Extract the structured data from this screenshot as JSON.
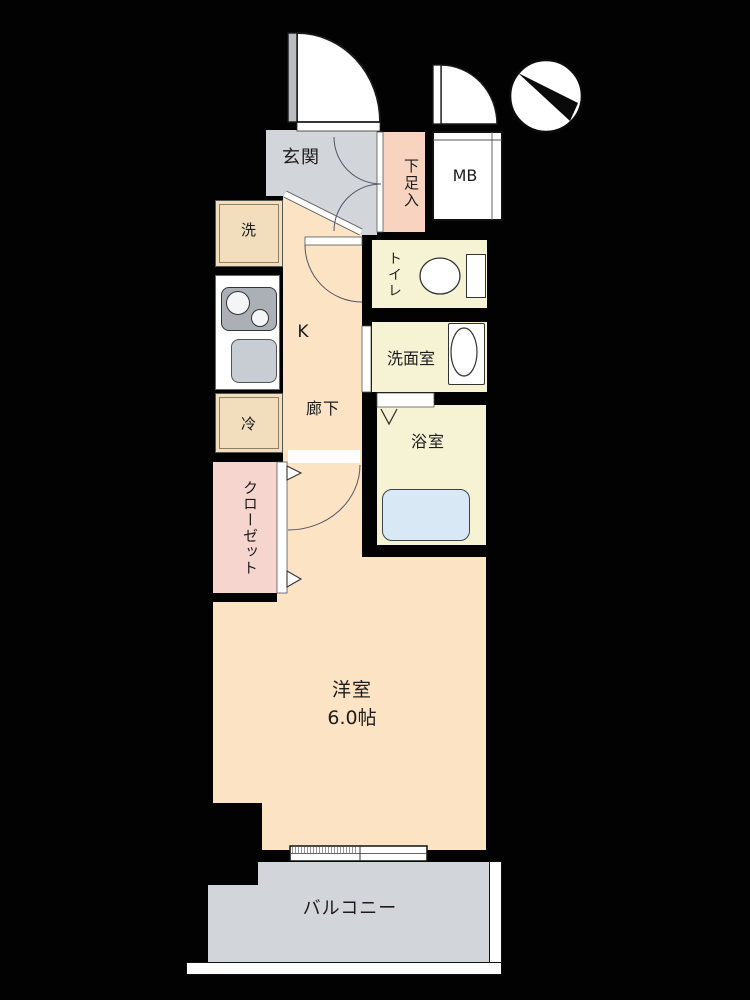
{
  "plan": {
    "type": "apartment-floor-plan",
    "rooms": {
      "genkan_label": "玄関",
      "shoe_cabinet_label": "下足入",
      "meter_box_label": "MB",
      "washer_label": "洗",
      "kitchen_label": "K",
      "hallway_label": "廊下",
      "refrigerator_label": "冷",
      "toilet_label": "トイレ",
      "washroom_label": "洗面室",
      "bathroom_label": "浴室",
      "closet_label": "クローゼット",
      "western_room_label": "洋室",
      "western_room_size": "6.0帖",
      "balcony_label": "バルコニー"
    },
    "icons": {
      "compass": "north-compass-icon",
      "entrance_door": "hinged-door-arc",
      "bathroom_door": "folding-door-mark",
      "window": "sliding-window-symbol"
    },
    "colors": {
      "wall": "#020202",
      "floor_peach": "#fbe3c4",
      "entrance_gray": "#d2d5da",
      "wet_room_yellow": "#f6f3d4",
      "shoe_cabinet_pink": "#f8d3c0",
      "closet_pink": "#f7d5cf",
      "bathtub_blue": "#d8e8f5",
      "fixture_beige": "#f2debd",
      "counter_white": "#ffffff",
      "stove_gray": "#abafb6",
      "sink_gray": "#c8cdd3"
    }
  }
}
